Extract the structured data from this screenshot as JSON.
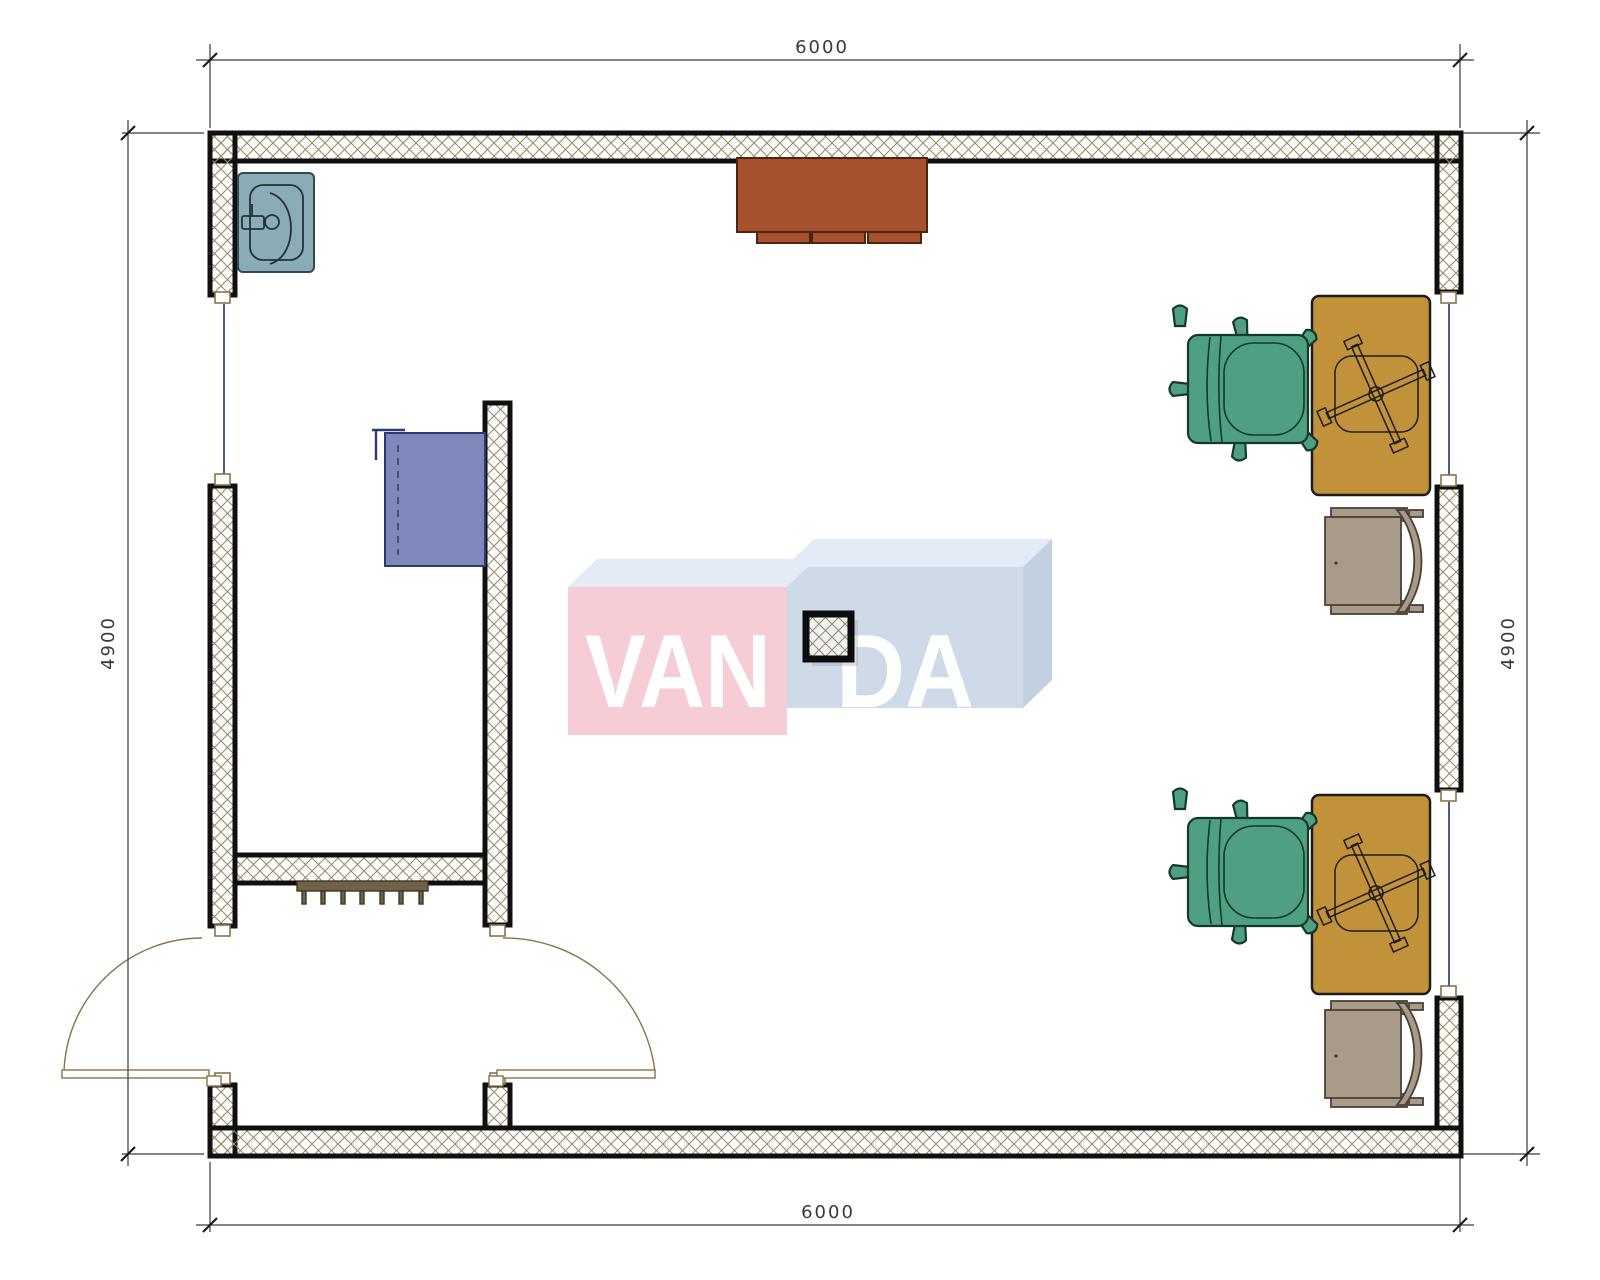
{
  "dimensions": {
    "top": "6000",
    "bottom": "6000",
    "left": "4900",
    "right": "4900"
  },
  "watermark": {
    "left": "VAN",
    "right": "DA"
  },
  "furniture": [
    "sink",
    "blue-cabinet",
    "brown-cabinet",
    "radiator",
    "column",
    "desk-with-task-chair-top",
    "desk-with-task-chair-bottom",
    "office-chair-green-top",
    "office-chair-green-bottom",
    "armchair-grey-middle",
    "armchair-grey-bottom",
    "entrance-double-door"
  ],
  "colors": {
    "hatch": "#9b8a63",
    "wall-stroke": "#101010",
    "desk": "#c2923b",
    "chair": "#4fa083",
    "chair-stroke": "#14382b",
    "armchair": "#a89b8a",
    "armchair-stroke": "#4a4034",
    "sink": "#8aacb6",
    "cab-blue": "#7f88ba",
    "cab-blue-stroke": "#2b3a6b",
    "cab-brown": "#a5512e",
    "cab-brown-stroke": "#4e2410",
    "radiator": "#6f6246",
    "door": "#8a7347",
    "window": "#24306b",
    "dim": "#3a3a3a",
    "wm-pink": "#f6ccd5",
    "wm-blue": "#cfdae9",
    "wm-top": "#e2ebf6",
    "wm-side": "#c3d0e0",
    "wm-text": "#ffffff"
  }
}
